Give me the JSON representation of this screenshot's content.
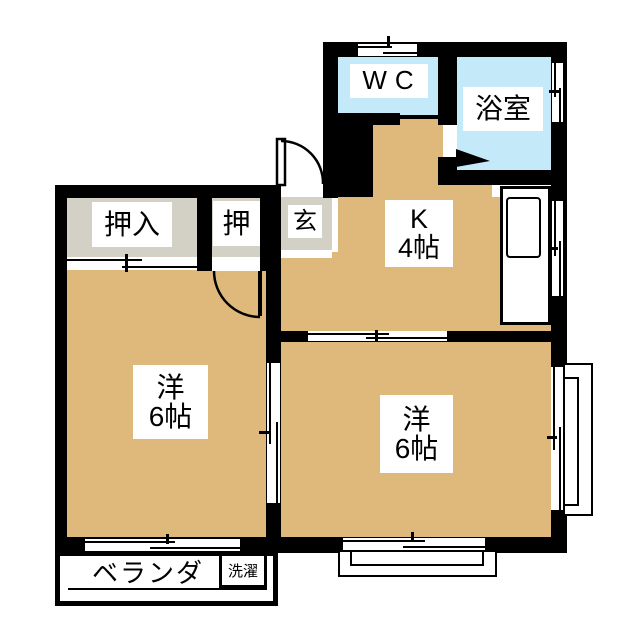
{
  "plan_title": "2K apartment floor plan",
  "colors": {
    "floor_tan": "#DFB87C",
    "water_blue": "#C4EAF9",
    "closet_gray": "#D3D0C5",
    "wall_black": "#000000",
    "label_bg": "#FFFFFF"
  },
  "rooms": {
    "wc": {
      "label": "WC"
    },
    "bath": {
      "label": "浴室"
    },
    "kitchen": {
      "label_line1": "K",
      "label_line2": "4帖"
    },
    "western_left": {
      "label_line1": "洋",
      "label_line2": "6帖"
    },
    "western_right": {
      "label_line1": "洋",
      "label_line2": "6帖"
    },
    "closet_large": {
      "label": "押入"
    },
    "closet_small": {
      "label": "押"
    },
    "entrance": {
      "label": "玄"
    },
    "veranda": {
      "label": "ベランダ"
    },
    "laundry": {
      "label": "洗濯"
    }
  }
}
